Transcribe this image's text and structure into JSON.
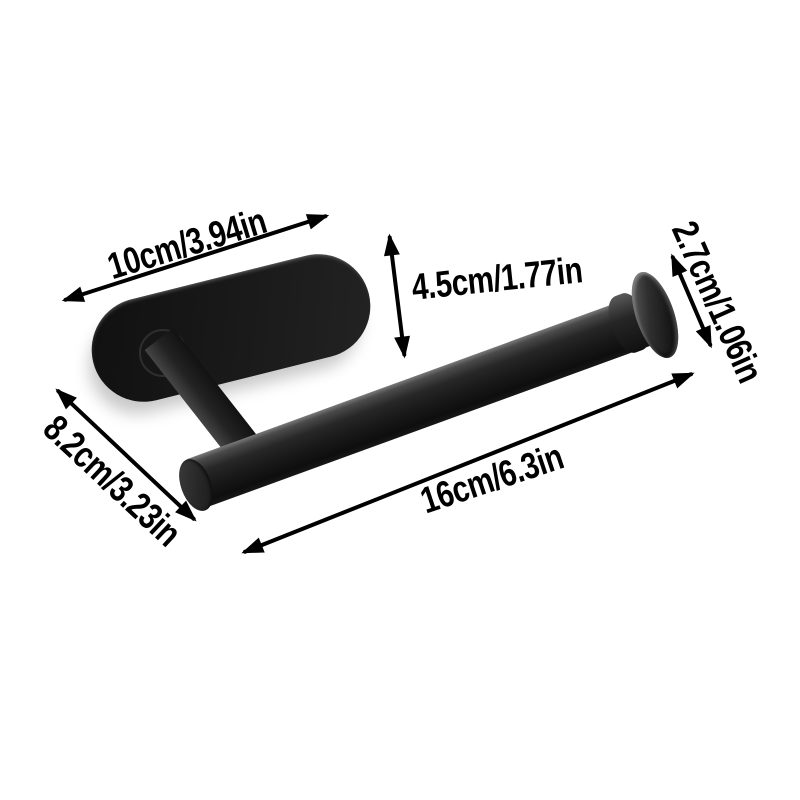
{
  "background_color": "#ffffff",
  "annotation_color": "#000000",
  "product": {
    "color": "#1a1a1a",
    "parts": [
      "wall-plate",
      "mount-ring",
      "support-post",
      "holder-bar",
      "bar-end-cap",
      "end-flange"
    ]
  },
  "dimensions": [
    {
      "name": "plate-length",
      "label": "10cm/3.94in"
    },
    {
      "name": "drop-height",
      "label": "4.5cm/1.77in"
    },
    {
      "name": "flange-diameter",
      "label": "2.7cm/1.06in"
    },
    {
      "name": "plate-width",
      "label": "8.2cm/3.23in"
    },
    {
      "name": "bar-length",
      "label": "16cm/6.3in"
    }
  ]
}
